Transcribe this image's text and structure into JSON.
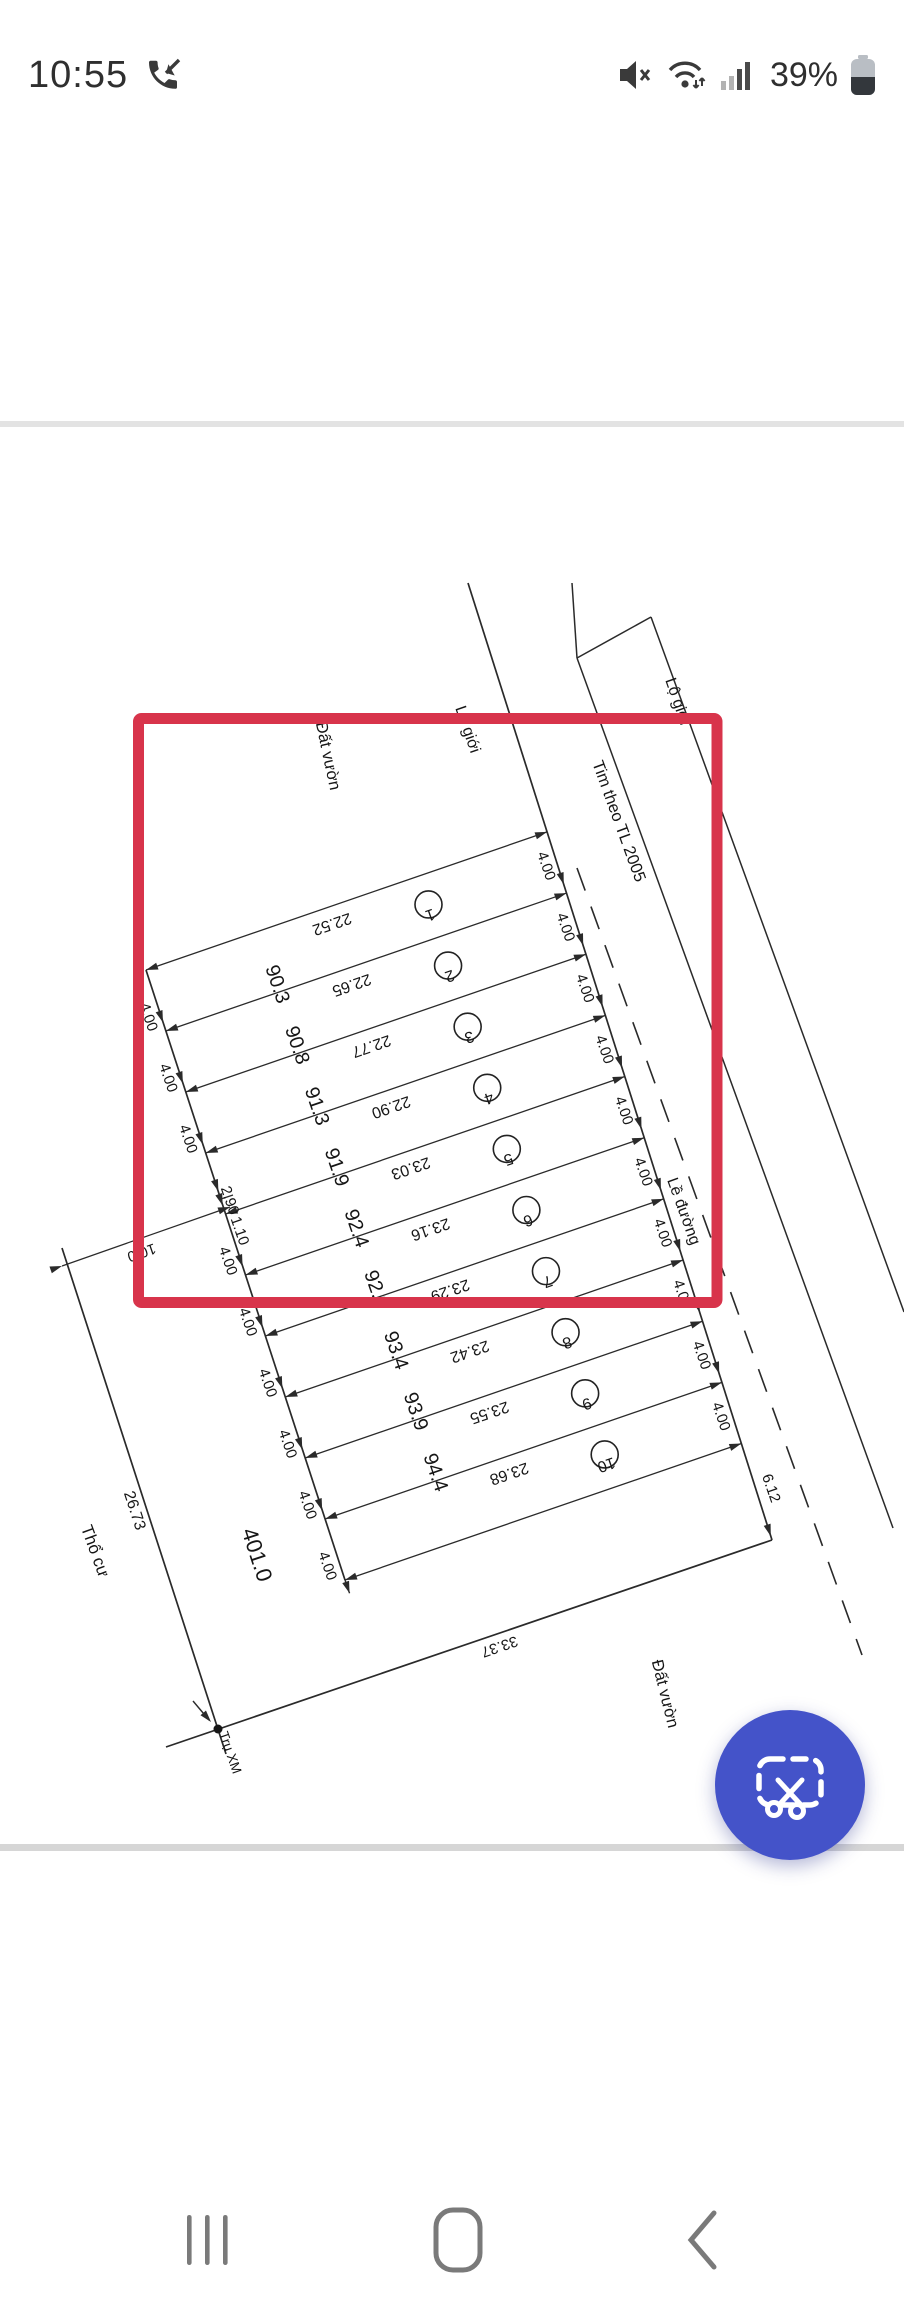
{
  "status_bar": {
    "time": "10:55",
    "battery_percent": "39%",
    "icons": [
      "missed-call",
      "mute",
      "wifi",
      "signal-strength",
      "battery"
    ]
  },
  "survey_plan": {
    "plots": [
      {
        "number": "1",
        "length": "22.52",
        "area": "90.3"
      },
      {
        "number": "2",
        "length": "22.65",
        "area": "90.8"
      },
      {
        "number": "3",
        "length": "22.77",
        "area": "91.3"
      },
      {
        "number": "4",
        "length": "22.90",
        "area": "91.9"
      },
      {
        "number": "5",
        "length": "23.03",
        "area": "92.4"
      },
      {
        "number": "6",
        "length": "23.16",
        "area": "92.9"
      },
      {
        "number": "7",
        "length": "23.29",
        "area": "93.4"
      },
      {
        "number": "8",
        "length": "23.42",
        "area": "93.9"
      },
      {
        "number": "9",
        "length": "23.55",
        "area": "94.4"
      },
      {
        "number": "10",
        "length": "23.68",
        "area": ""
      }
    ],
    "plot_width_label": "4.00",
    "split_widths": [
      "2.90",
      "1.10"
    ],
    "right_end_width": "6.12",
    "front_dim": "10.0",
    "left_boundary_length": "26.73",
    "bottom_boundary_length": "33.37",
    "remaining_parcel_area": "401.0",
    "road_centerline_label": "Tim theo TL 2005",
    "road_shoulder_label": "Lề đường",
    "road_boundary_label": "Lộ giới",
    "garden_land_label": "Đất vườn",
    "residential_land_label": "Thổ cư",
    "survey_post_label": "Trụ XM"
  },
  "annotation": {
    "highlight_color": "#d8344b"
  },
  "fab": {
    "background": "#4453c9",
    "icon": "crop-scissors"
  },
  "navigation": {
    "items": [
      "recents",
      "home",
      "back"
    ]
  }
}
